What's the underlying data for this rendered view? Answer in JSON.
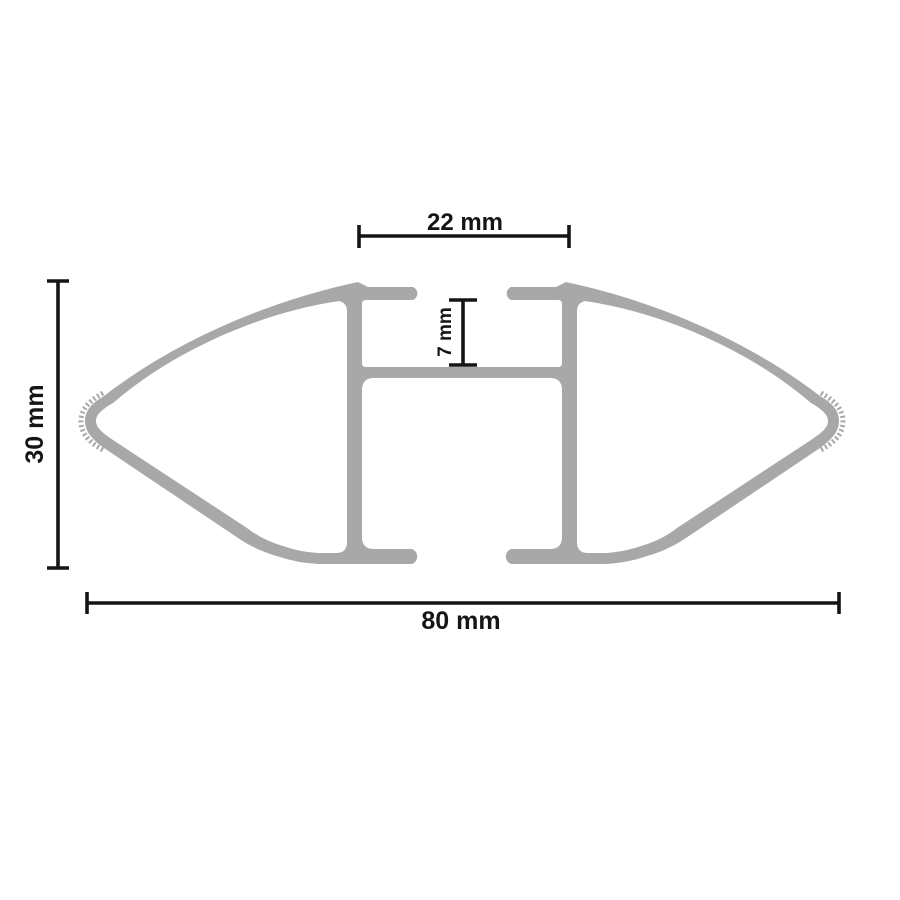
{
  "diagram": {
    "subject": "roof-bar-profile-cross-section",
    "colors": {
      "background": "#ffffff",
      "profile": "#a8a8a8",
      "dimension": "#151515"
    },
    "dimensions": {
      "top_channel_width": {
        "label": "22 mm",
        "value": 22,
        "unit": "mm",
        "orientation": "horizontal"
      },
      "channel_depth": {
        "label": "7 mm",
        "value": 7,
        "unit": "mm",
        "orientation": "vertical"
      },
      "profile_height": {
        "label": "30 mm",
        "value": 30,
        "unit": "mm",
        "orientation": "vertical"
      },
      "profile_width": {
        "label": "80 mm",
        "value": 80,
        "unit": "mm",
        "orientation": "horizontal"
      }
    }
  }
}
